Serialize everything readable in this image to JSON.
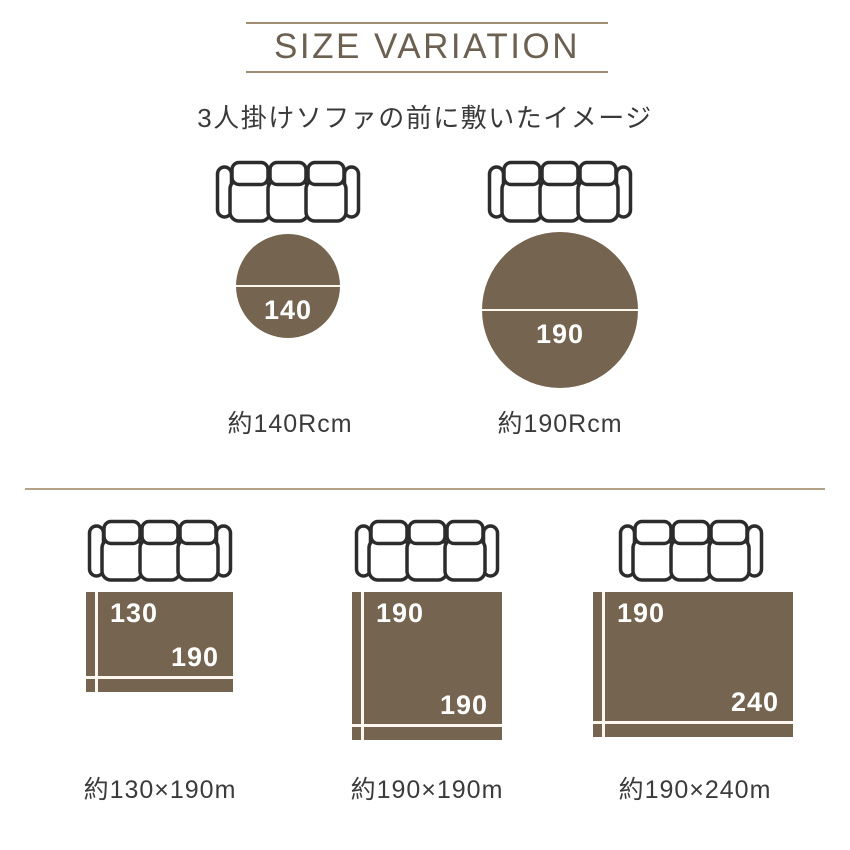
{
  "header": {
    "title": "SIZE VARIATION",
    "subtitle": "3人掛けソファの前に敷いたイメージ"
  },
  "icons": {
    "sofa": "sofa-top-view"
  },
  "colors": {
    "rug_brown": "#75644f",
    "title_brown": "#6c6050",
    "rule_tan": "#a18e71",
    "divider_tan": "#b4a286",
    "text_dark": "#3a3a3a",
    "label_white": "#ffffff",
    "sofa_stroke": "#2c2c2c"
  },
  "round_rugs": [
    {
      "diameter_label": "140",
      "caption": "約140Rcm"
    },
    {
      "diameter_label": "190",
      "caption": "約190Rcm"
    }
  ],
  "rect_rugs": [
    {
      "height_label": "130",
      "width_label": "190",
      "caption": "約130×190m"
    },
    {
      "height_label": "190",
      "width_label": "190",
      "caption": "約190×190m"
    },
    {
      "height_label": "190",
      "width_label": "240",
      "caption": "約190×240m"
    }
  ]
}
